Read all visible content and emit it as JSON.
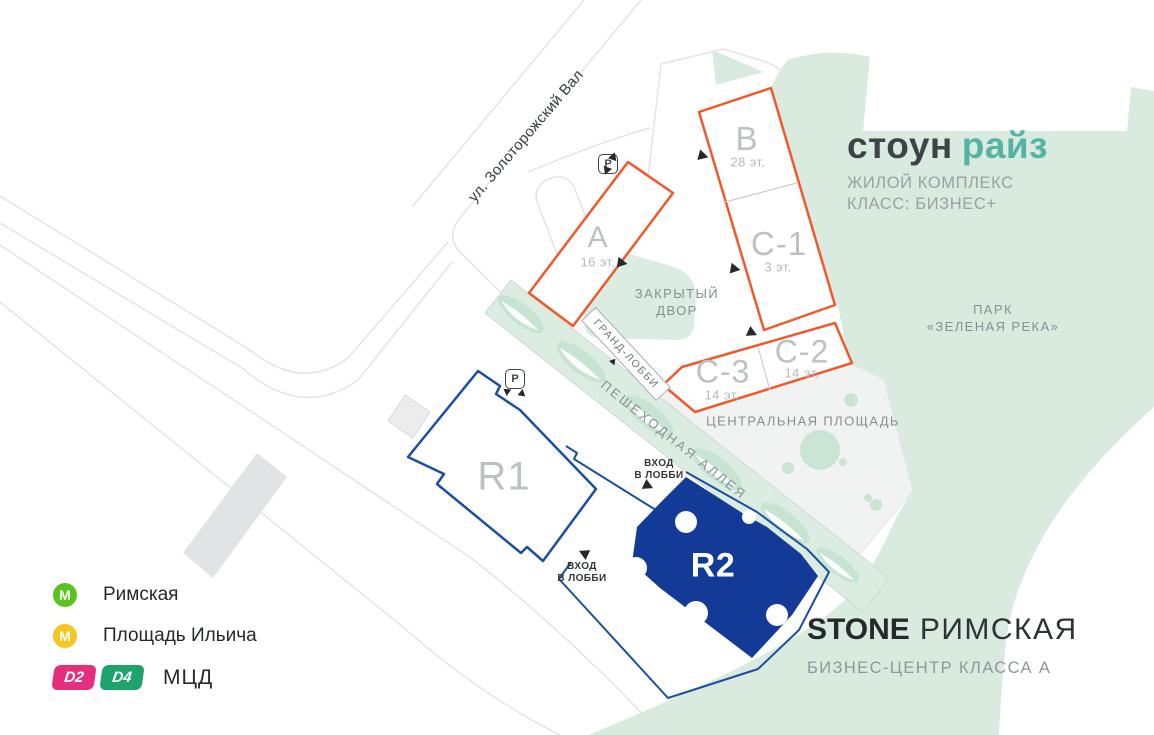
{
  "map": {
    "street_label": "ул. Золоторожский Вал",
    "park_label_line1": "ПАРК",
    "park_label_line2": "«ЗЕЛЕНАЯ РЕКА»",
    "courtyard_line1": "ЗАКРЫТЫЙ",
    "courtyard_line2": "ДВОР",
    "grand_lobby": "ГРАНД-ЛОББИ",
    "alley": "ПЕШЕХОДНАЯ АЛЛЕЯ",
    "central_square": "ЦЕНТРАЛЬНАЯ ПЛОЩАДЬ",
    "parking": "P",
    "entrance_line1": "ВХОД",
    "entrance_line2": "В ЛОББИ"
  },
  "buildings": [
    {
      "id": "A",
      "floors": "16 эт."
    },
    {
      "id": "B",
      "floors": "28 эт."
    },
    {
      "id": "C-1",
      "floors": "3 эт."
    },
    {
      "id": "C-3",
      "floors": "14 эт."
    },
    {
      "id": "C-2",
      "floors": "14 эт."
    },
    {
      "id": "R1",
      "floors": ""
    },
    {
      "id": "R2",
      "floors": ""
    }
  ],
  "residential_logo": {
    "word1": "стоун",
    "word2": "райз",
    "accent_color": "#55b3a4",
    "line1": "ЖИЛОЙ КОМПЛЕКС",
    "line2": "КЛАСС: БИЗНЕС+"
  },
  "business_center": {
    "brand": "STONE",
    "name": "РИМСКАЯ",
    "subtitle": "БИЗНЕС-ЦЕНТР КЛАССА А"
  },
  "legend": {
    "stations": [
      {
        "icon": "М",
        "color": "#5cc31e",
        "name": "Римская"
      },
      {
        "icon": "М",
        "color": "#f6c51e",
        "name": "Площадь Ильича"
      }
    ],
    "mcd": {
      "label": "МЦД",
      "lines": [
        {
          "id": "D2",
          "color": "#e62e7f"
        },
        {
          "id": "D4",
          "color": "#1fa36c"
        }
      ]
    }
  },
  "colors": {
    "building_outline_orange": "#f1592a",
    "building_outline_blue": "#1c4ea1",
    "r2_fill": "#133a96",
    "park_green": "#d9ebdf"
  }
}
